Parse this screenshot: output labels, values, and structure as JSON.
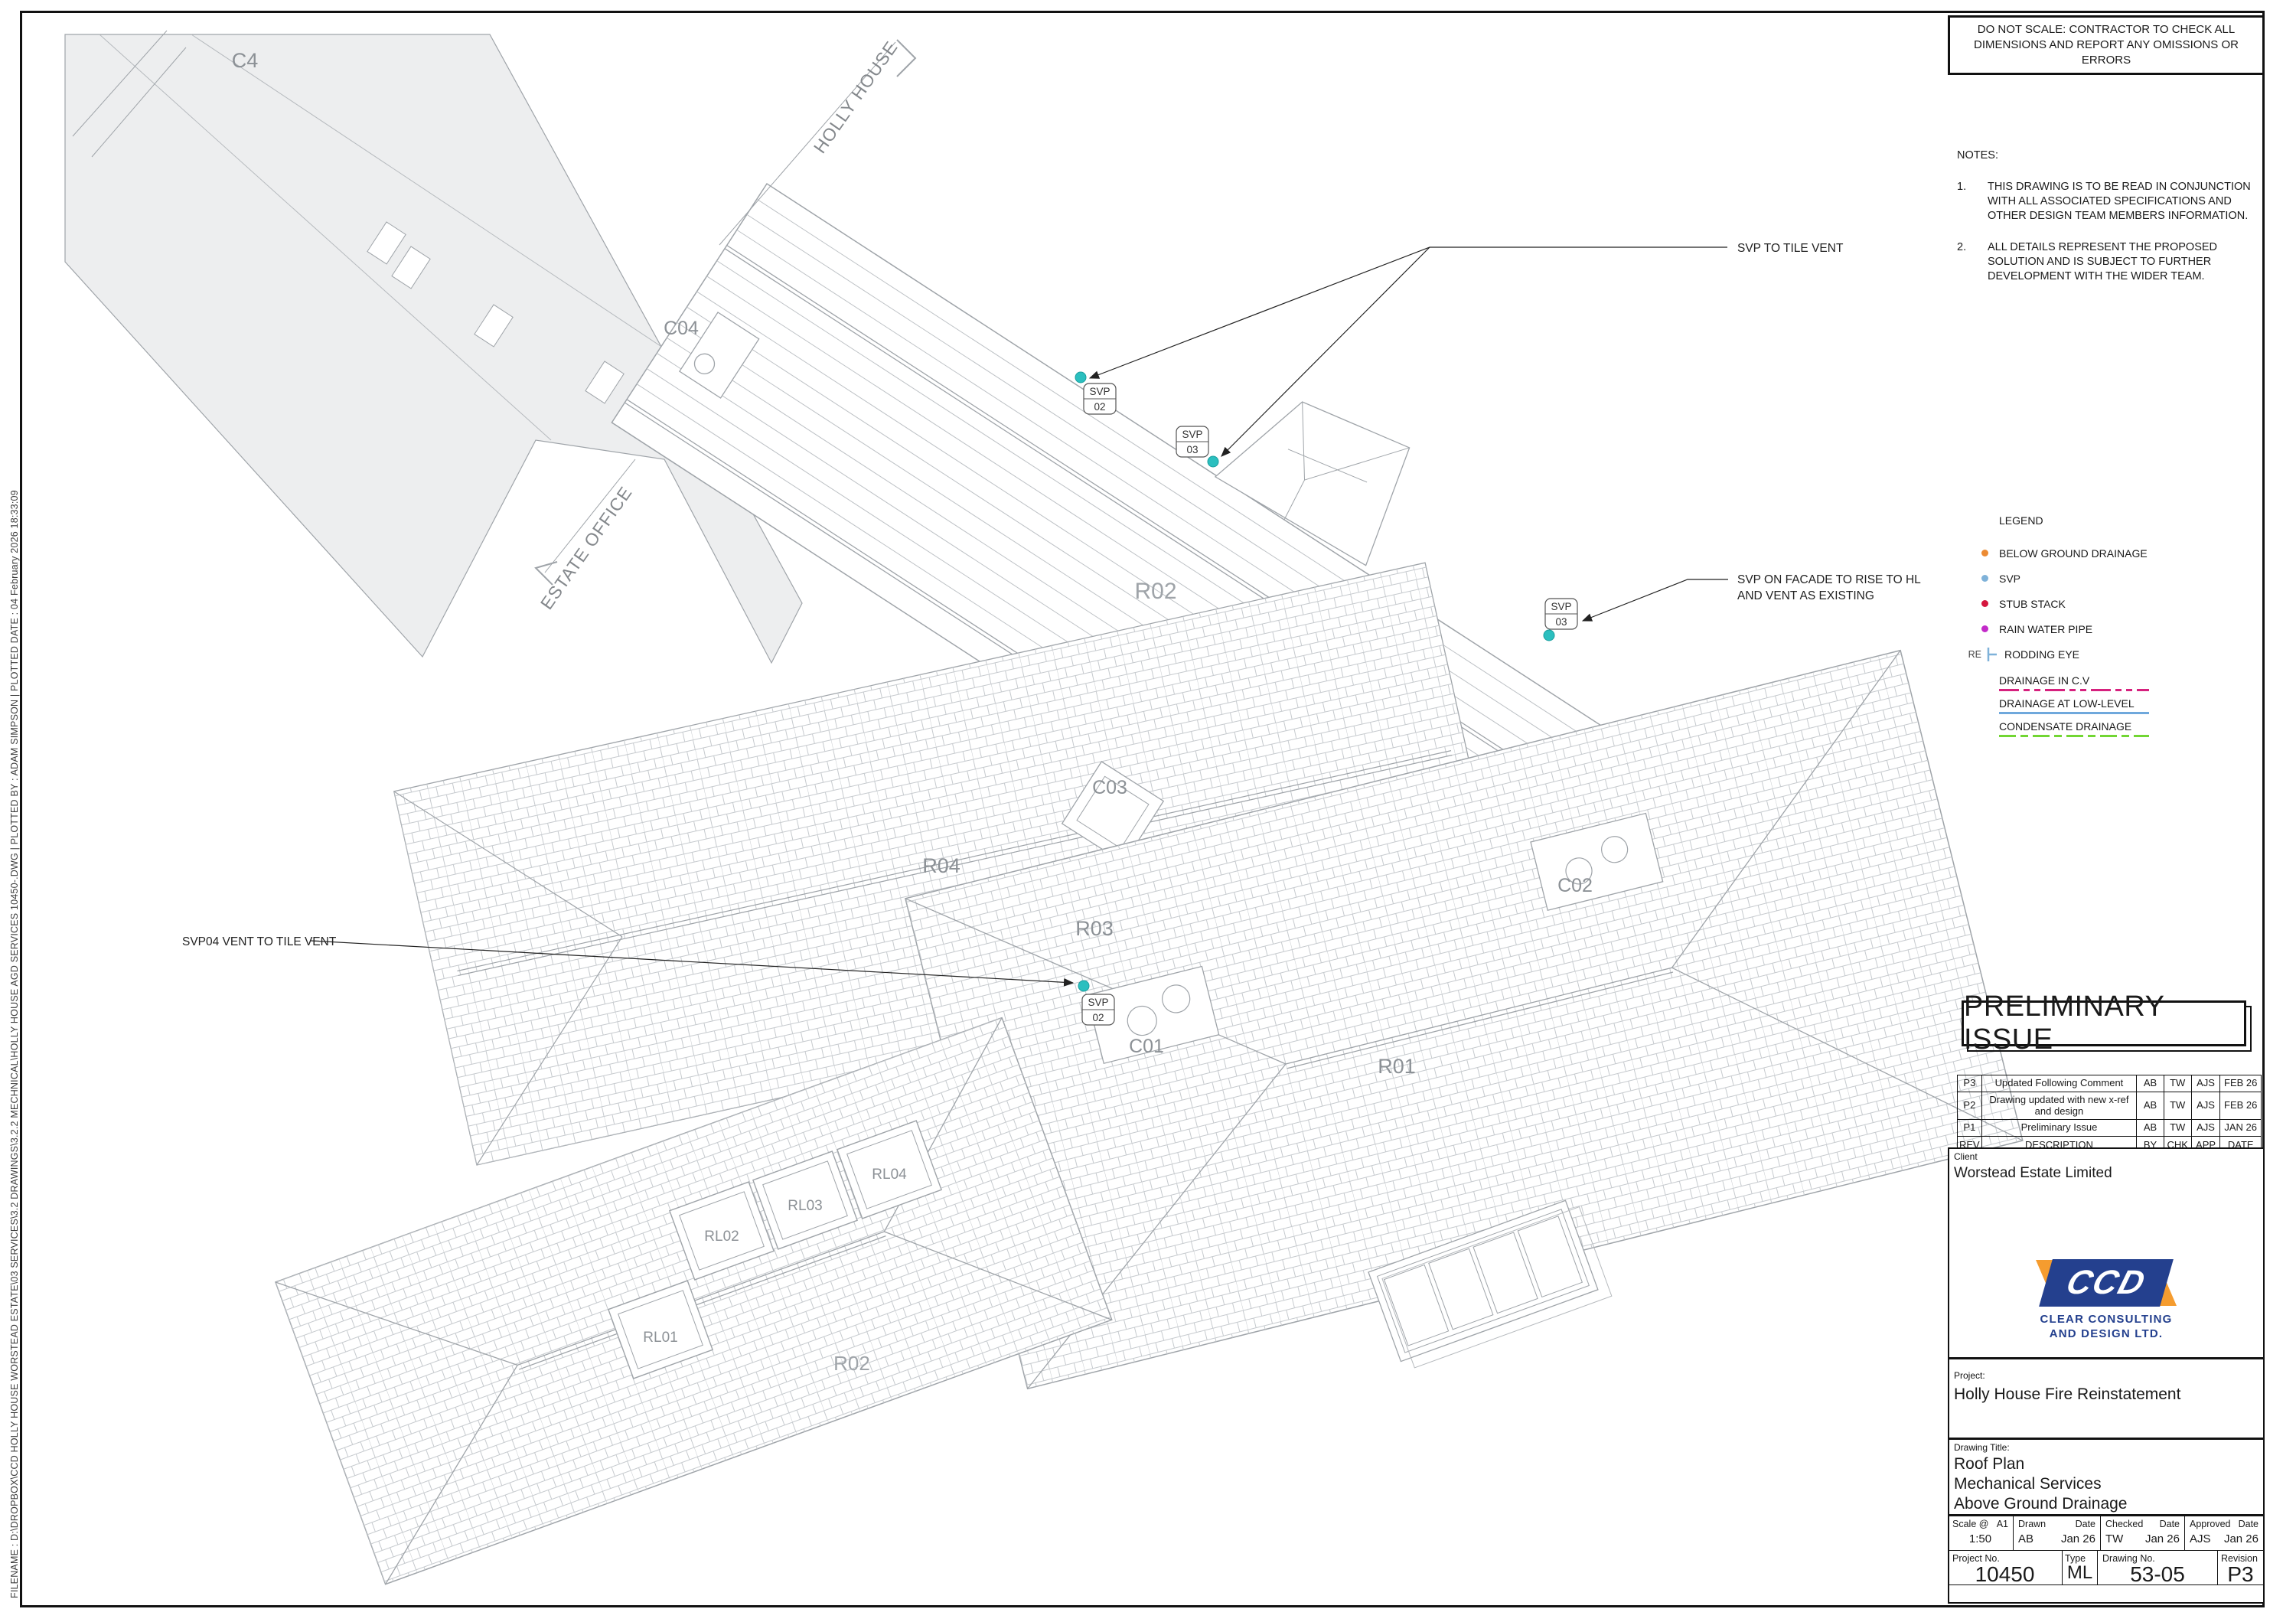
{
  "sheet": {
    "do_not_scale": "DO NOT SCALE: CONTRACTOR TO CHECK ALL DIMENSIONS AND REPORT ANY OMISSIONS OR ERRORS",
    "plot_info": "FILENAME : D:\\DROPBOX\\CCD HOLLY HOUSE WORSTEAD ESTATE\\03 SERVICES\\3.2 DRAWINGS\\3.2.2 MECHNICAL\\HOLLY HOUSE AGD SERVICES 10450-.DWG   |   PLOTTED BY : ADAM SIMPSON   |   PLOTTED DATE : 04 February 2026 18:33:09"
  },
  "notes": {
    "title": "NOTES:",
    "items": [
      {
        "num": "1.",
        "text": "THIS DRAWING IS TO BE READ IN CONJUNCTION WITH ALL ASSOCIATED SPECIFICATIONS AND OTHER DESIGN TEAM MEMBERS INFORMATION."
      },
      {
        "num": "2.",
        "text": "ALL DETAILS REPRESENT THE PROPOSED SOLUTION AND IS SUBJECT TO FURTHER DEVELOPMENT WITH THE WIDER TEAM."
      }
    ]
  },
  "legend": {
    "title": "LEGEND",
    "items": [
      {
        "label": "BELOW GROUND DRAINAGE",
        "color": "#EC8B33"
      },
      {
        "label": "SVP",
        "color": "#7FB2D9"
      },
      {
        "label": "STUB STACK",
        "color": "#D5173E"
      },
      {
        "label": "RAIN WATER PIPE",
        "color": "#C32BC9"
      }
    ],
    "rodding": {
      "prefix": "RE",
      "label": "RODDING EYE",
      "color": "#7FB2D9"
    },
    "lines": [
      {
        "label": "DRAINAGE IN C.V",
        "color": "#D6217E",
        "style": "dashed"
      },
      {
        "label": "DRAINAGE AT LOW-LEVEL",
        "color": "#6FA8DC",
        "style": "solid"
      },
      {
        "label": "CONDENSATE DRAINAGE",
        "color": "#72D633",
        "style": "dashed"
      }
    ]
  },
  "plan": {
    "labels": {
      "c4": "C4",
      "c04": "C04",
      "r02_main": "R02",
      "holly_house": "HOLLY HOUSE",
      "estate_office": "ESTATE OFFICE",
      "c03": "C03",
      "r04": "R04",
      "r03": "R03",
      "c01": "C01",
      "c02": "C02",
      "r01": "R01",
      "r02_wing": "R02",
      "rl01": "RL01",
      "rl02": "RL02",
      "rl03": "RL03",
      "rl04": "RL04"
    },
    "svp_tags": [
      {
        "top": "SVP",
        "num": "02"
      },
      {
        "top": "SVP",
        "num": "03"
      },
      {
        "top": "SVP",
        "num": "03"
      },
      {
        "top": "SVP",
        "num": "02"
      }
    ],
    "annotations": {
      "svp_tile_vent": "SVP TO TILE VENT",
      "svp_facade_1": "SVP ON FACADE TO RISE TO HL",
      "svp_facade_2": "AND VENT AS EXISTING",
      "svp04_vent": "SVP04 VENT TO TILE VENT"
    },
    "colors": {
      "svp_marker": "#2BBFBF",
      "roof_line": "#9FA4A9",
      "label_gray": "#8C9196"
    }
  },
  "status_stamp": "PRELIMINARY ISSUE",
  "revisions": {
    "header": {
      "rev": "REV",
      "description": "DESCRIPTION",
      "by": "BY",
      "chk": "CHK",
      "app": "APP",
      "date": "DATE"
    },
    "rows": [
      {
        "rev": "P3",
        "description": "Updated Following Comment",
        "by": "AB",
        "chk": "TW",
        "app": "AJS",
        "date": "FEB 26"
      },
      {
        "rev": "P2",
        "description": "Drawing updated with new x-ref and design",
        "by": "AB",
        "chk": "TW",
        "app": "AJS",
        "date": "FEB 26"
      },
      {
        "rev": "P1",
        "description": "Preliminary Issue",
        "by": "AB",
        "chk": "TW",
        "app": "AJS",
        "date": "JAN 26"
      }
    ]
  },
  "client": {
    "label": "Client",
    "name": "Worstead Estate Limited"
  },
  "logo": {
    "abbr": "CCD",
    "line1": "CLEAR CONSULTING",
    "line2": "AND DESIGN LTD.",
    "blue": "#24408E",
    "orange": "#F59C2F"
  },
  "project": {
    "label": "Project:",
    "name": "Holly House Fire Reinstatement"
  },
  "drawing_title": {
    "label": "Drawing Title:",
    "line1": "Roof Plan",
    "line2": "Mechanical Services",
    "line3": "Above Ground Drainage"
  },
  "info": {
    "scale_label": "Scale @",
    "scale_sheet": "A1",
    "scale_value": "1:50",
    "drawn_label": "Drawn",
    "drawn": "AB",
    "date_label": "Date",
    "drawn_date": "Jan 26",
    "checked_label": "Checked",
    "checked": "TW",
    "checked_date": "Jan 26",
    "approved_label": "Approved",
    "approved": "AJS",
    "approved_date": "Jan 26",
    "project_no_label": "Project No.",
    "project_no": "10450",
    "type_label": "Type",
    "type": "ML",
    "drawing_no_label": "Drawing No.",
    "drawing_no": "53-05",
    "revision_label": "Revision",
    "revision": "P3"
  }
}
